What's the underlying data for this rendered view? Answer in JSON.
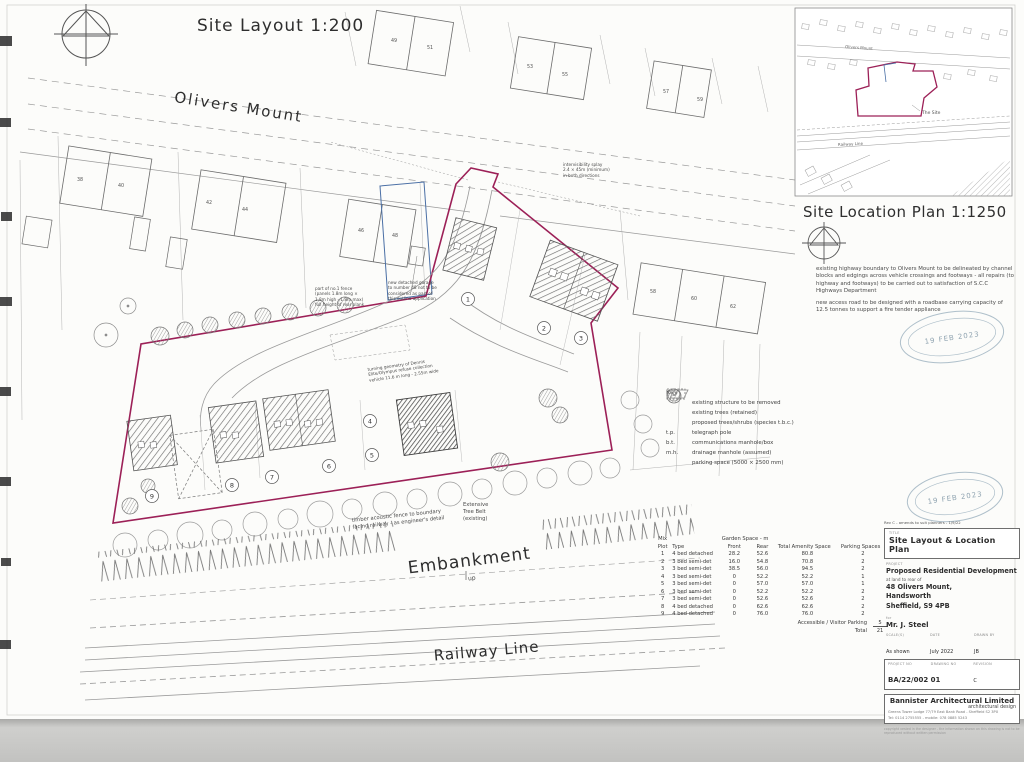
{
  "drawing": {
    "title_main": "Site Layout 1:200",
    "title_location": "Site Location Plan 1:1250",
    "street": "Olivers Mount",
    "railway": "Railway Line",
    "embankment": "Embankment",
    "embankment_dir": "up"
  },
  "site": {
    "boundary_color": "#9c2057",
    "plot_labels": [
      "1",
      "2",
      "3",
      "4",
      "5",
      "6",
      "7",
      "8",
      "9"
    ],
    "houses_top": [
      "49",
      "51",
      "53",
      "55",
      "57",
      "59"
    ],
    "houses_left": [
      "38",
      "40",
      "42",
      "44",
      "46",
      "48"
    ],
    "houses_right": [
      "58",
      "60",
      "62"
    ]
  },
  "annotations": {
    "intervisibility": "intervisibility splay\n2.4 × 45m (minimum)\nin both directions",
    "garage_note": "new detached garage\nto number 48 not to be\nconsidered as part of\nthis outline application",
    "fence_note": "part of no.1 fence\n(panels 1.8m long ×\n1.8m high - 1.8m max)\nfull height of rear plank",
    "turning_note": "turning geometry of Dennis\nElite/Olympus refuse collection\nvehicle 11.6 m long - 2.55m wide",
    "tree_belt": "Extensive\nTree Belt\n(existing)",
    "acoustic_fence": "timber acoustic fence to boundary\nfacing railway - as engineer's detail"
  },
  "location_plan": {
    "street": "Olivers Mount",
    "site_label": "The Site",
    "railway": "Railway Line"
  },
  "highway_notes": {
    "para1": "existing highway boundary to Olivers Mount to be delineated by channel blocks and edgings across vehicle crossings and footways - all repairs (to highway and footways) to be carried out to satisfaction of S.C.C Highways Department",
    "para2": "new access road to be designed with a roadbase carrying capacity of 12.5 tonnes to support a fire tender appliance"
  },
  "stamp": {
    "date": "19 FEB 2023"
  },
  "key": {
    "title": "Key",
    "items": [
      {
        "abbr": "",
        "label": "existing structure to be removed"
      },
      {
        "abbr": "",
        "label": "existing trees (retained)"
      },
      {
        "abbr": "",
        "label": "proposed trees/shrubs (species t.b.c.)"
      },
      {
        "abbr": "t.p.",
        "label": "telegraph pole"
      },
      {
        "abbr": "b.t.",
        "label": "communications manhole/box"
      },
      {
        "abbr": "m.h.",
        "label": "drainage manhole (assumed)"
      },
      {
        "abbr": "",
        "label": "parking space (5000 × 2500 mm)"
      }
    ]
  },
  "schedule": {
    "mix_label": "Mix",
    "garden_label": "Garden Space - m",
    "headers": {
      "plot": "Plot",
      "type": "Type",
      "front": "Front",
      "rear": "Rear",
      "total": "Total Amenity Space",
      "parking": "Parking Spaces"
    },
    "rows": [
      {
        "plot": "1",
        "type": "4 bed detached",
        "front": "28.2",
        "rear": "52.6",
        "total": "80.8",
        "parking": "2"
      },
      {
        "plot": "2",
        "type": "3 bed semi-det",
        "front": "16.0",
        "rear": "54.8",
        "total": "70.8",
        "parking": "2"
      },
      {
        "plot": "3",
        "type": "3 bed semi-det",
        "front": "38.5",
        "rear": "56.0",
        "total": "94.5",
        "parking": "2"
      },
      {
        "plot": "4",
        "type": "3 bed semi-det",
        "front": "0",
        "rear": "52.2",
        "total": "52.2",
        "parking": "1"
      },
      {
        "plot": "5",
        "type": "3 bed semi-det",
        "front": "0",
        "rear": "57.0",
        "total": "57.0",
        "parking": "1"
      },
      {
        "plot": "6",
        "type": "3 bed semi-det",
        "front": "0",
        "rear": "52.2",
        "total": "52.2",
        "parking": "2"
      },
      {
        "plot": "7",
        "type": "3 bed semi-det",
        "front": "0",
        "rear": "52.6",
        "total": "52.6",
        "parking": "2"
      },
      {
        "plot": "8",
        "type": "4 bed detached",
        "front": "0",
        "rear": "62.6",
        "total": "62.6",
        "parking": "2"
      },
      {
        "plot": "9",
        "type": "4 bed detached",
        "front": "0",
        "rear": "76.0",
        "total": "76.0",
        "parking": "2"
      }
    ],
    "footer": {
      "accessible_label": "Accessible / Visitor Parking",
      "accessible_value": "5",
      "total_label": "Total",
      "total_value": "21"
    }
  },
  "titleblock": {
    "rev_note": "Rev C - amends to suit planners - 1/9/22",
    "title_label": "TITLE",
    "title": "Site Layout & Location Plan",
    "project_label": "PROJECT",
    "project_line1": "Proposed Residential Development",
    "project_sub": "at land to rear of",
    "project_line2": "48 Olivers Mount,",
    "project_line3": "Handsworth",
    "project_line4": "Sheffield, S9 4PB",
    "for_label": "for",
    "client": "Mr. J. Steel",
    "scale_label": "SCALE(S)",
    "scale": "As shown",
    "date_label": "DATE",
    "date": "July 2022",
    "drawn_label": "DRAWN BY",
    "drawn": "JB",
    "projno_label": "PROJECT NO",
    "projno": "BA/22/002",
    "dwgno_label": "DRAWING NO",
    "dwgno": "01",
    "rev_label": "REVISION",
    "rev": "C",
    "firm": "Bannister Architectural Limited",
    "firm_tag": "architectural design",
    "firm_addr": "Greens Tower Lodge 77/79 East Bank Road - Sheffield S2 3PX",
    "firm_tel": "Tel: 0114 2755555 - mobile: 078 0885 5243",
    "copyright": "copyright vested in the designer - the information shown on this drawing is not to be reproduced without written permission"
  }
}
